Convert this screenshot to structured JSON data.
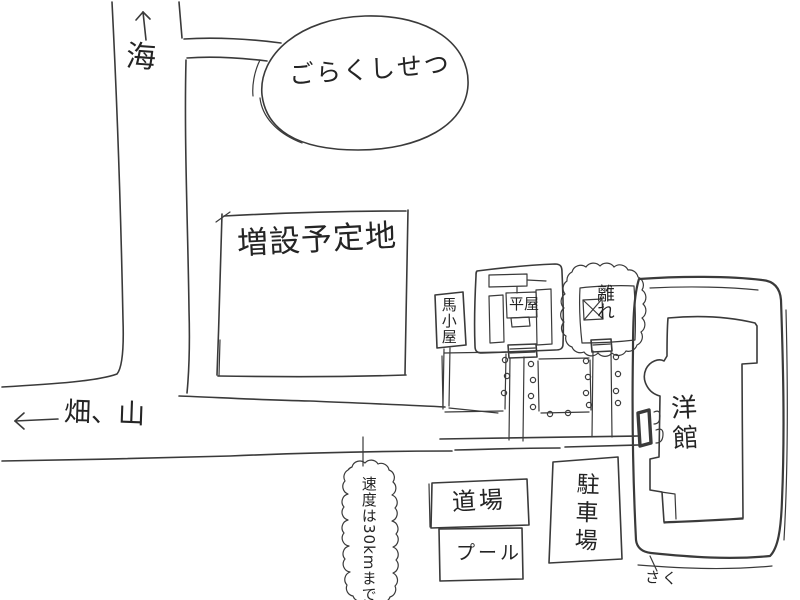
{
  "canvas": {
    "background": "#ffffff",
    "ink_color": "#3a3a3a",
    "style": "hand-drawn pencil site map"
  },
  "map": {
    "labels": {
      "sea": "海",
      "sea_arrow_direction": "up",
      "facility": "ごらくしせつ",
      "expansion_site": "増設予定地",
      "stable": "馬小屋",
      "main_house": "平屋",
      "annex": "離れ",
      "western_house": "洋館",
      "fields_mountain": "畑、山",
      "fields_arrow_direction": "left",
      "speed_sign": "速度は30kmまで",
      "dojo": "道場",
      "pool": "プール",
      "parking": "駐車場",
      "fence": "さく"
    }
  }
}
